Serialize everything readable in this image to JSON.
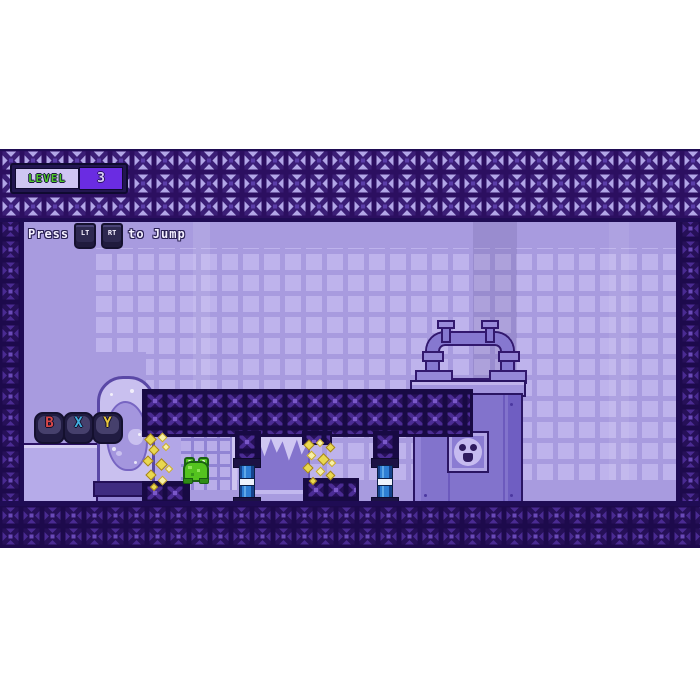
{
  "hud": {
    "level_badge": {
      "label": "LEVEL",
      "value": "3",
      "label_color": "#4ec828",
      "panel_color": "#6a2ce2"
    },
    "instruction": {
      "prefix": "Press",
      "keys": [
        "LT",
        "RT"
      ],
      "suffix": "to Jump"
    },
    "gamepad_buttons": [
      {
        "label": "B",
        "color": "#d84747"
      },
      {
        "label": "X",
        "color": "#41aede"
      },
      {
        "label": "Y",
        "color": "#e9c83b"
      }
    ]
  },
  "scene": {
    "player": "green-frog",
    "props": [
      "specimen-tank-with-creature",
      "truss-girder-platform",
      "blue-support-pillars",
      "truss-crates",
      "sparkle-streams",
      "broken-window",
      "glass-block-window",
      "reactor-machine-with-pipes",
      "radiation-warning-plate"
    ],
    "palette": {
      "wall": "#a89bdf",
      "wall_tile": "#beb3ec",
      "truss_dark_fill": "#4a2b92",
      "truss_girder_fill": "#261058",
      "truss_light_cell": "#b2a6e7",
      "pillar_blue": "#2e7ed4",
      "sparkle_yellow": "#e9d84f",
      "frog_green": "#54c31f"
    }
  }
}
